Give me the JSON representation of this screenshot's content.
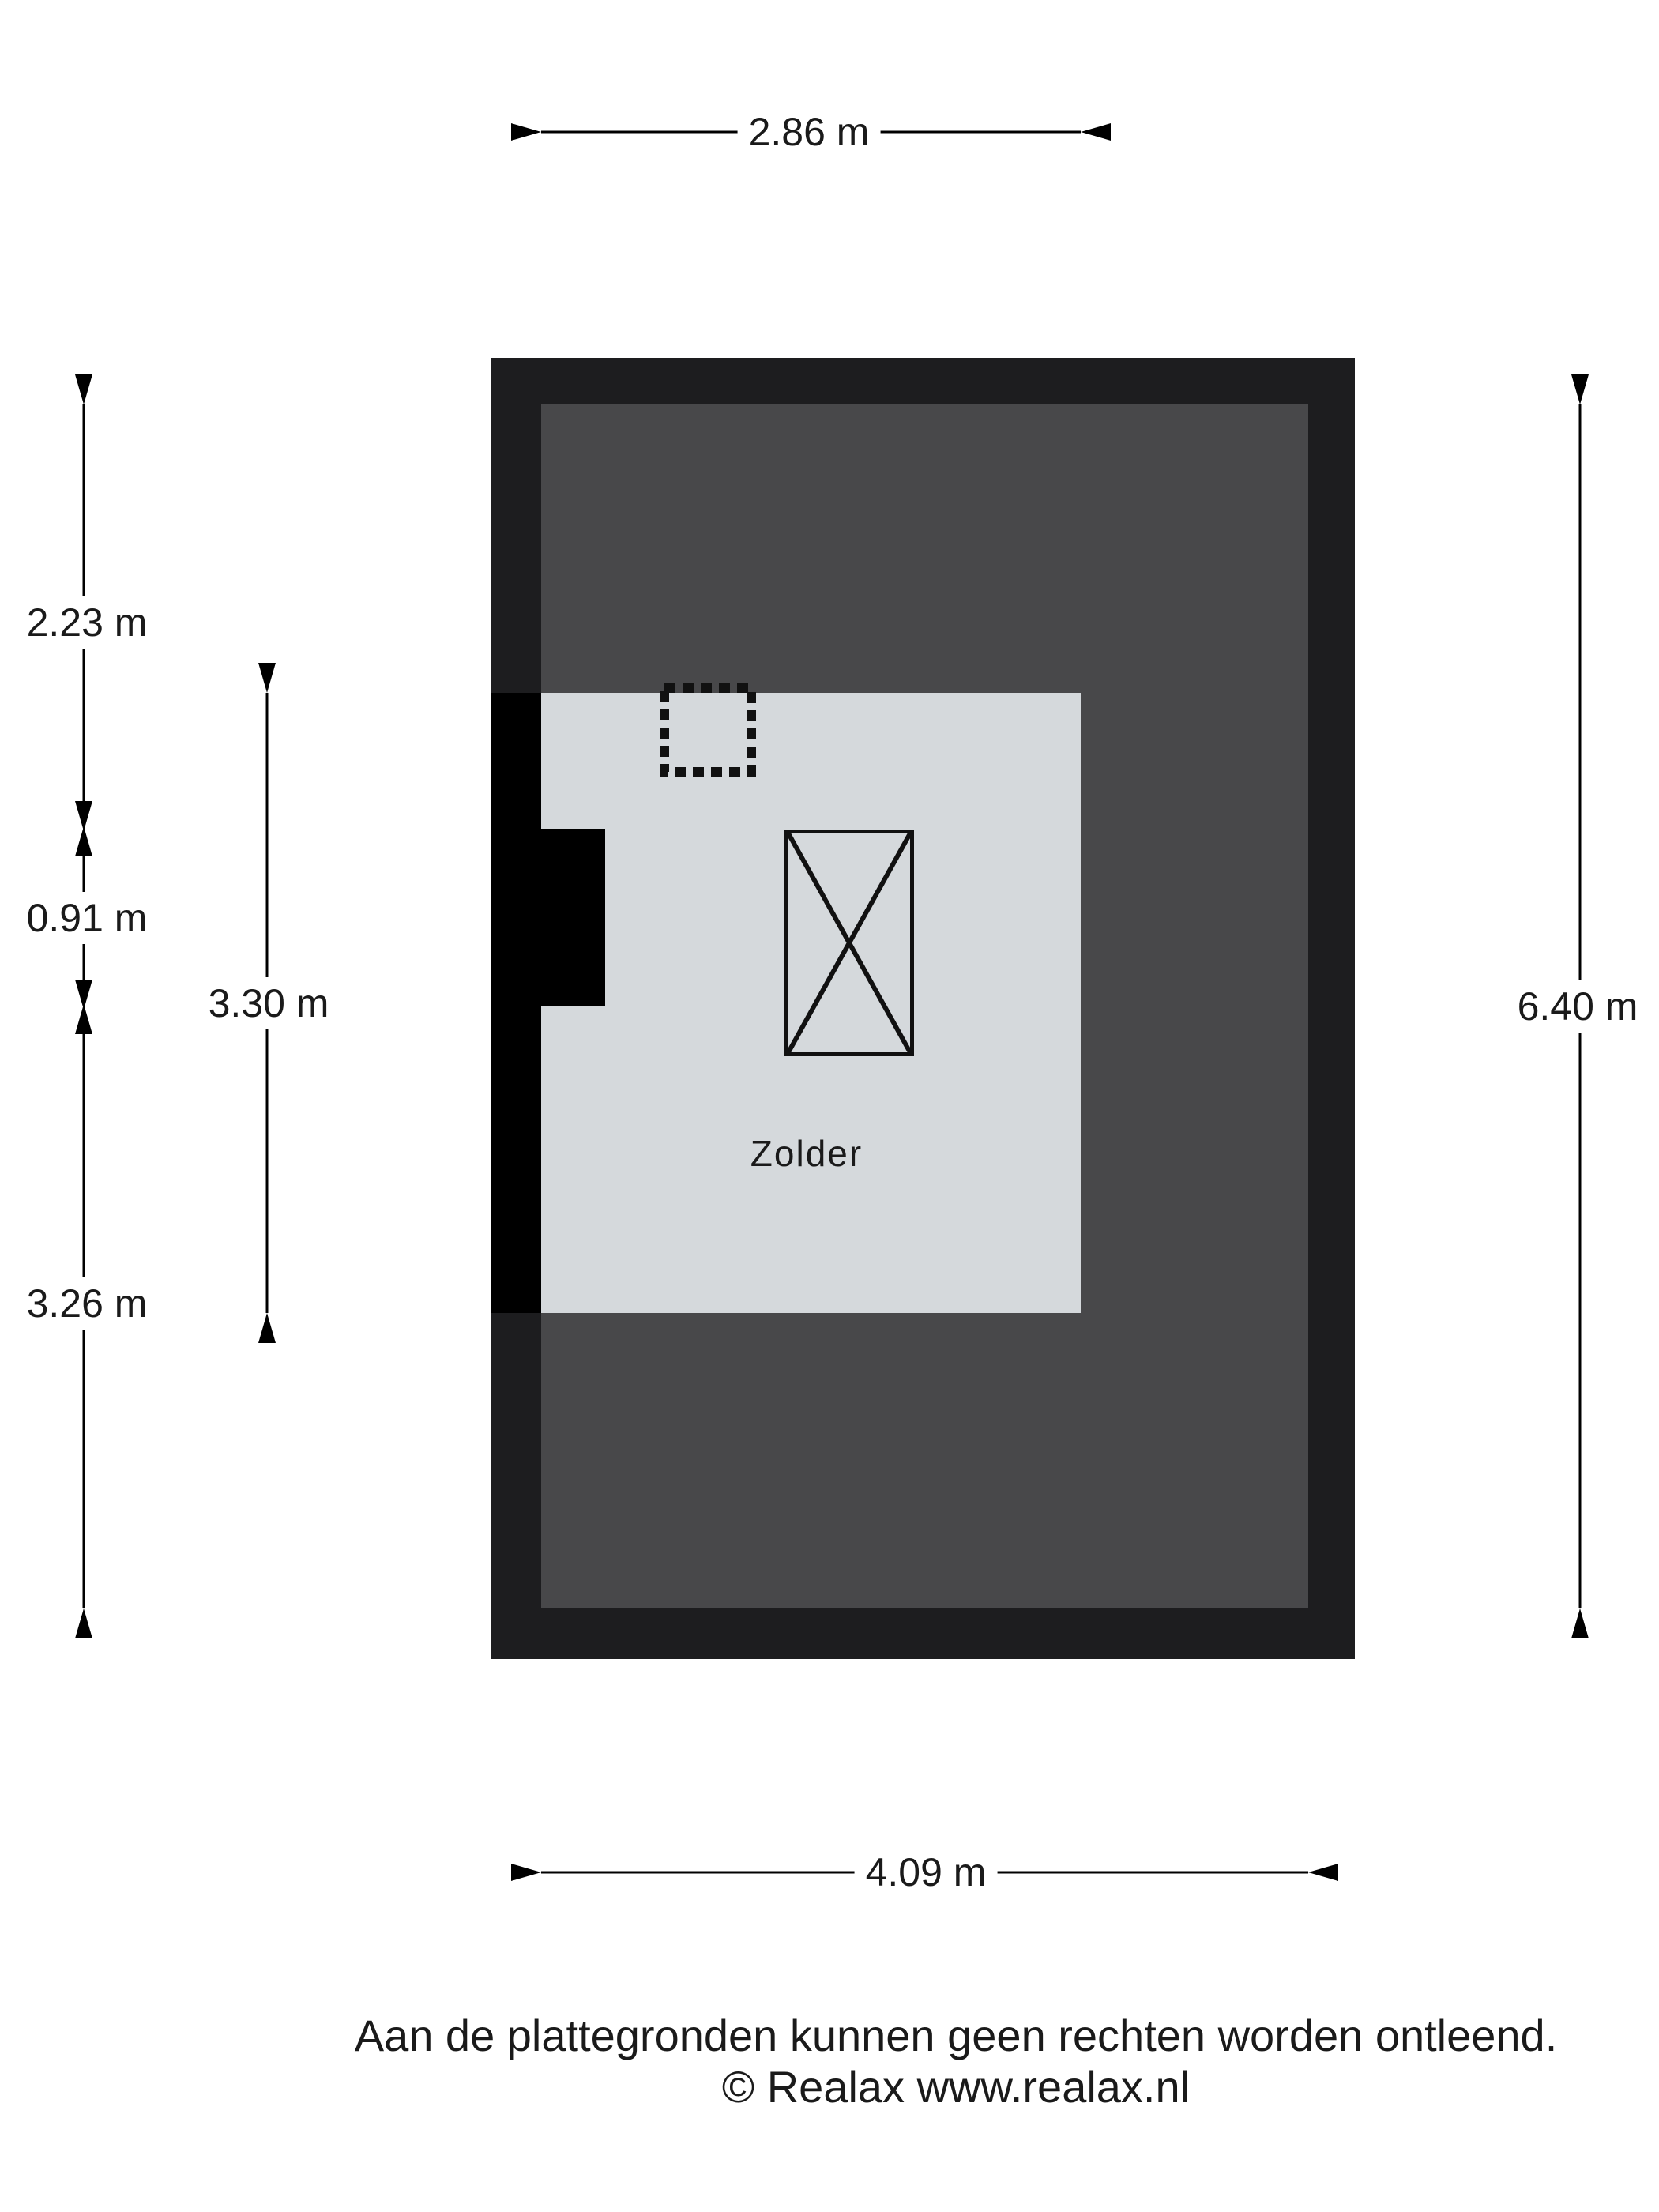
{
  "room": {
    "label": "Zolder"
  },
  "dimensions": {
    "room_width_top": "2.86 m",
    "left_upper": "2.23 m",
    "left_middle": "0.91 m",
    "left_lower": "3.26 m",
    "room_height_inner": "3.30 m",
    "right_full_height": "6.40 m",
    "bottom_width": "4.09 m"
  },
  "footer": {
    "disclaimer": "Aan de plattegronden kunnen geen rechten worden ontleend.",
    "copyright": "© Realax www.realax.nl"
  },
  "colors": {
    "wall-dark": "#1d1d1f",
    "floor-dark": "#48484a",
    "room-light": "#d5d9dc",
    "wall-black": "#000000",
    "ink": "#1a1a1a",
    "page-bg": "#ffffff"
  }
}
